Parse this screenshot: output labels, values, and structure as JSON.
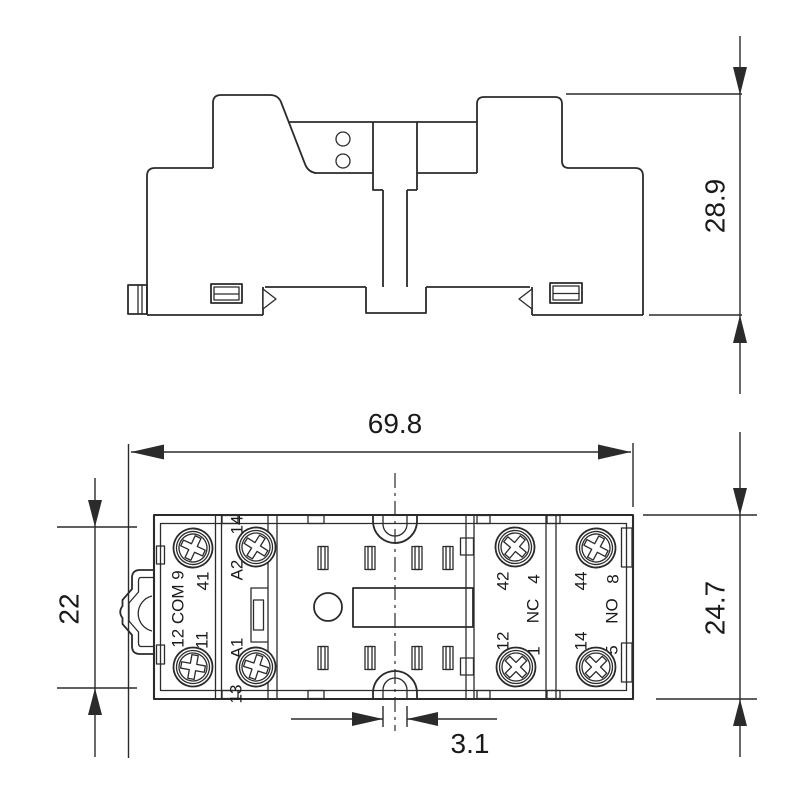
{
  "drawing": {
    "kind": "relay-socket-dimension-drawing",
    "colors": {
      "line": "#2b2b2b",
      "background": "#ffffff",
      "text": "#1a1a1a"
    },
    "dimensions": {
      "side_height": "28.9",
      "overall_width": "69.8",
      "body_height": "22",
      "overall_depth": "24.7",
      "notch_width": "3.1"
    },
    "terminals": {
      "com_column": [
        "41",
        "12 COM 9",
        "11"
      ],
      "coil_column": [
        "14",
        "A2",
        "A1",
        "13"
      ],
      "nc_column": [
        "42",
        "4",
        "NC",
        "12",
        "1"
      ],
      "no_column": [
        "44",
        "8",
        "NO",
        "14",
        "5"
      ]
    }
  }
}
